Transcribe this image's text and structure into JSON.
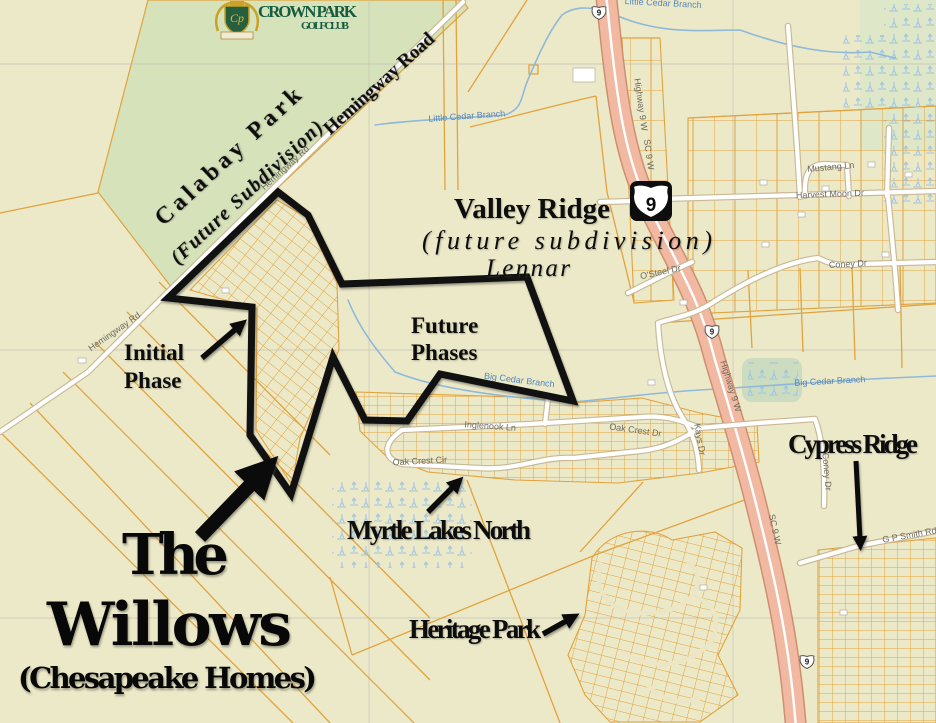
{
  "map": {
    "developer_logo": {
      "name": "CROWN PARK",
      "subtitle": "GOLF CLUB",
      "monogram": "Cp"
    },
    "title": {
      "line1": "The",
      "line2": "Willows",
      "line3": "(Chesapeake Homes)"
    },
    "annotations": {
      "calabay_park": {
        "name": "Calabay Park",
        "status": "(Future Subdivision)"
      },
      "hemingway_road_label": "Hemingway Road",
      "valley_ridge": {
        "name": "Valley Ridge",
        "status": "(future subdivision)",
        "builder": "Lennar"
      },
      "initial_phase": {
        "line1": "Initial",
        "line2": "Phase"
      },
      "future_phases": {
        "line1": "Future",
        "line2": "Phases"
      },
      "myrtle_lakes_north": "Myrtle Lakes North",
      "heritage_park": "Heritage Park",
      "cypress_ridge": "Cypress Ridge"
    },
    "highway_shield": "9",
    "road_labels": {
      "hemingway_rd_a": "Hemingway Rd",
      "hemingway_rd_b": "Hemingway Rd",
      "highway9w_a": "Highway 9 W",
      "sc9w_a": "SC 9 W",
      "highway9w_b": "Highway 9 W",
      "sc9w_b": "SC 9 W",
      "osteel_dr": "O'Steel Dr",
      "mustang_ln": "Mustang Ln",
      "harvest_moon_dr": "Harvest Moon Dr",
      "coney_dr_a": "Coney Dr",
      "coney_dr_b": "Coney Dr",
      "kays_dr": "Kays Dr",
      "inglenook_ln": "Inglenook Ln",
      "oak_crest_cir": "Oak Crest Cir",
      "oak_crest_dr": "Oak Crest Dr",
      "gp_smith_rd": "G P Smith Rd"
    },
    "water_labels": {
      "little_cedar_branch": "Little Cedar Branch",
      "little_cedar_branch_top": "Little Cedar Branch",
      "big_cedar_branch_w": "Big Cedar Branch",
      "big_cedar_branch_e": "Big Cedar Branch"
    },
    "colors": {
      "background": "#ece9c8",
      "calabay_green": "#d6e2ba",
      "parcel_orange": "#e2a23c",
      "highway_pink": "#f2b9a2",
      "water_blue": "#8fb8da",
      "boundary_black": "#111111",
      "logo_green": "#155c40"
    }
  }
}
